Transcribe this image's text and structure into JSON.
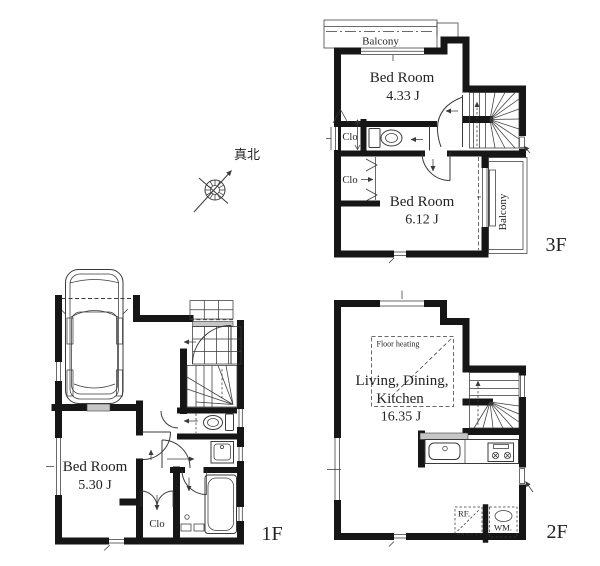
{
  "colors": {
    "wall": "#161616",
    "line": "#3a3a3a",
    "text": "#232323",
    "grey": "#c6c6c6",
    "bg": "#ffffff"
  },
  "compass": {
    "label": "真北"
  },
  "floors": {
    "f3": {
      "label": "3F",
      "balcony_top": "Balcony",
      "balcony_right": "Balcony",
      "bedroom1": {
        "name": "Bed Room",
        "size": "4.33 J"
      },
      "bedroom2": {
        "name": "Bed Room",
        "size": "6.12 J"
      },
      "closet1": "Clo",
      "closet2": "Clo"
    },
    "f2": {
      "label": "2F",
      "floor_heating": "Floor heating",
      "room": {
        "line1": "Living, Dining,",
        "line2": "Kitchen",
        "size": "16.35 J"
      },
      "refrigerator": "RF.",
      "washing_machine": "WM."
    },
    "f1": {
      "label": "1F",
      "bedroom": {
        "name": "Bed Room",
        "size": "5.30 J"
      },
      "closet": "Clo"
    }
  }
}
